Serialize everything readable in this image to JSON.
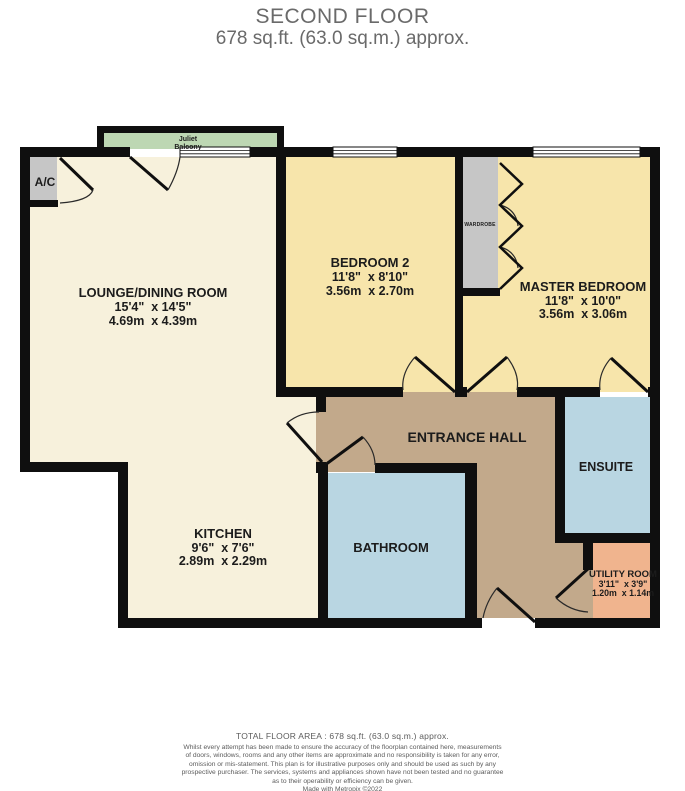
{
  "header": {
    "title": "SECOND FLOOR",
    "subtitle": "678 sq.ft. (63.0 sq.m.) approx."
  },
  "plan": {
    "balcony": {
      "line1": "Juliet",
      "line2": "Balcony"
    },
    "ac_label": "A/C",
    "wardrobe_label": "WARDROBE",
    "rooms": {
      "lounge": {
        "name": "LOUNGE/DINING ROOM",
        "imperial": "15'4\"  x 14'5\"",
        "metric": "4.69m  x 4.39m"
      },
      "bedroom2": {
        "name": "BEDROOM 2",
        "imperial": "11'8\"  x 8'10\"",
        "metric": "3.56m  x 2.70m"
      },
      "master": {
        "name": "MASTER BEDROOM",
        "imperial": "11'8\"  x 10'0\"",
        "metric": "3.56m  x 3.06m"
      },
      "kitchen": {
        "name": "KITCHEN",
        "imperial": "9'6\"  x 7'6\"",
        "metric": "2.89m  x 2.29m"
      },
      "hall": {
        "name": "ENTRANCE HALL"
      },
      "bathroom": {
        "name": "BATHROOM"
      },
      "ensuite": {
        "name": "ENSUITE"
      },
      "utility": {
        "name": "UTILITY ROOM",
        "imperial": "3'11\"  x 3'9\"",
        "metric": "1.20m  x 1.14m"
      }
    }
  },
  "footer": {
    "total": "TOTAL FLOOR AREA : 678 sq.ft. (63.0 sq.m.) approx.",
    "disclaimer": [
      "Whilst every attempt has been made to ensure the accuracy of the floorplan contained here, measurements",
      "of doors, windows, rooms and any other items are approximate and no responsibility is taken for any error,",
      "omission or mis-statement. This plan is for illustrative purposes only and should be used as such by any",
      "prospective purchaser. The services, systems and appliances shown have not been tested and no guarantee",
      "as to their operability or efficiency can be given.",
      "Made with Metropix ©2022"
    ]
  },
  "colors": {
    "wall": "#0f0f0f",
    "lounge_kitchen": "#f7f1dc",
    "bedroom": "#f7e5ab",
    "hall": "#c2a98b",
    "bathroom_ensuite": "#b9d6e2",
    "utility": "#f0b48e",
    "balcony": "#bdd7b3",
    "cupboard": "#c6c6c6",
    "window": "#ffffff",
    "title_text": "#6a6a6a",
    "label_text": "#1c1c1c"
  }
}
